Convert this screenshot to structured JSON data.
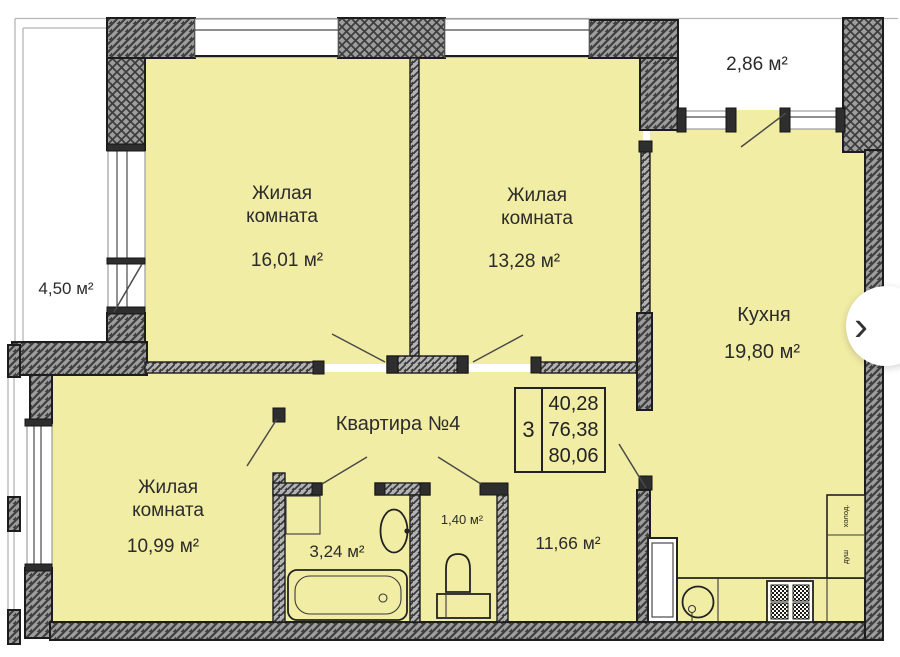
{
  "apartment": {
    "label": "Квартира №4"
  },
  "rooms": [
    {
      "id": "living-room-1",
      "name": "Жилая комната",
      "area": "16,01 м²"
    },
    {
      "id": "living-room-2",
      "name": "Жилая комната",
      "area": "13,28 м²"
    },
    {
      "id": "kitchen",
      "name": "Кухня",
      "area": "19,80 м²"
    },
    {
      "id": "living-room-3",
      "name": "Жилая комната",
      "area": "10,99 м²"
    },
    {
      "id": "bathroom",
      "name": "",
      "area": "3,24 м²"
    },
    {
      "id": "wc",
      "name": "",
      "area": "1,40 м²"
    },
    {
      "id": "hallway",
      "name": "",
      "area": "11,66 м²"
    }
  ],
  "balconies": [
    {
      "id": "balcony-left",
      "area": "4,50 м²"
    },
    {
      "id": "balcony-top",
      "area": "2,86 м²"
    }
  ],
  "stamp": {
    "rooms_count": "3",
    "areas": [
      "40,28",
      "76,38",
      "80,06"
    ]
  },
  "kitchen_units": {
    "fridge_label": "холод.",
    "shower_label": "душ"
  },
  "nav": {
    "next_label": "›",
    "next_icon_name": "chevron-right-icon"
  },
  "colors": {
    "room_fill": "#f2eda5",
    "wall_fill": "#9d9d9d",
    "line": "#1d1d1d",
    "background": "#ffffff"
  }
}
